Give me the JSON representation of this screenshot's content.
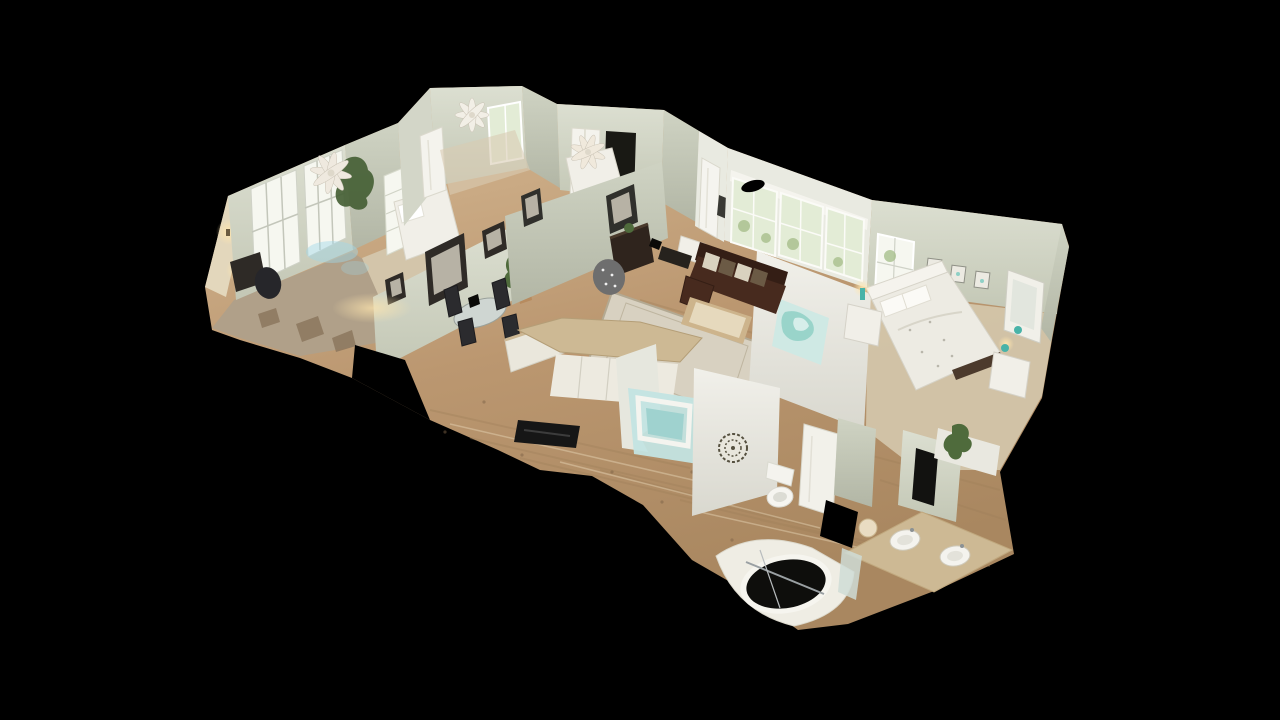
{
  "viewer": {
    "name": "3d-home-tour-dollhouse-view",
    "view_mode": "dollhouse",
    "chrome": "none",
    "background_color": "#000000"
  },
  "palette": {
    "bg": "#000000",
    "black_void": "#0a0a08",
    "wall": "#d3d6c8",
    "wall_shade": "#bcc0b0",
    "wall_bright": "#e9eae1",
    "wall_white": "#efeee8",
    "wall_warm": "#e3d7bc",
    "floor_wood": "#c3a57f",
    "floor_wood_dark": "#9e7f59",
    "floor_wood_light": "#ddc9a8",
    "carpet": "#d3c5aa",
    "rug": "#d8d1c1",
    "sofa": "#472a1e",
    "dark_wood": "#2f241d",
    "chair_dark": "#2b2b2e",
    "white_furn": "#f1efe8",
    "teal": "#49b3a8",
    "teal_soft": "#cfe9e4",
    "plant": "#4f6b3c",
    "window": "#f6f7f0",
    "window_green": "#e3ecd6",
    "counter": "#cdb994",
    "glow_warm": "#ffe6ae",
    "metal": "#9aa0a3"
  },
  "scene": {
    "description": "Cut-away 3D photogrammetry dollhouse of a single-story home seen from above at an oblique angle on a black background",
    "rooms": [
      {
        "id": "office",
        "features": [
          "lattice windows",
          "wall sconces",
          "desk",
          "office chair",
          "ceiling fan"
        ]
      },
      {
        "id": "bedroom-left",
        "features": [
          "white shutter windows",
          "white bed"
        ]
      },
      {
        "id": "bedroom-top-a",
        "features": [
          "ceiling fan",
          "white door",
          "window"
        ]
      },
      {
        "id": "bedroom-top-b",
        "features": [
          "ceiling fan",
          "white closet doors",
          "white bed"
        ]
      },
      {
        "id": "dining-area",
        "features": [
          "three framed pictures",
          "potted plant",
          "glass table",
          "four dark chairs"
        ]
      },
      {
        "id": "living-room",
        "features": [
          "dark brown sofa",
          "patterned pillows",
          "coffee table",
          "area rug",
          "picture windows",
          "front door",
          "dark dresser",
          "accent chair",
          "teal wall art"
        ]
      },
      {
        "id": "kitchen",
        "features": [
          "white cabinets",
          "angled island",
          "granite counter"
        ]
      },
      {
        "id": "guest-bathroom",
        "features": [
          "teal tub surround",
          "round wall medallion",
          "toilet",
          "white door"
        ]
      },
      {
        "id": "master-bedroom",
        "features": [
          "white bed",
          "white headboard",
          "nightstand",
          "teal lamps",
          "three small frames",
          "window",
          "mirrored dresser"
        ]
      },
      {
        "id": "master-bathroom",
        "features": [
          "double-sink vanity",
          "corner garden tub",
          "glass panel",
          "plant"
        ]
      }
    ],
    "ceiling_fans": 3
  }
}
